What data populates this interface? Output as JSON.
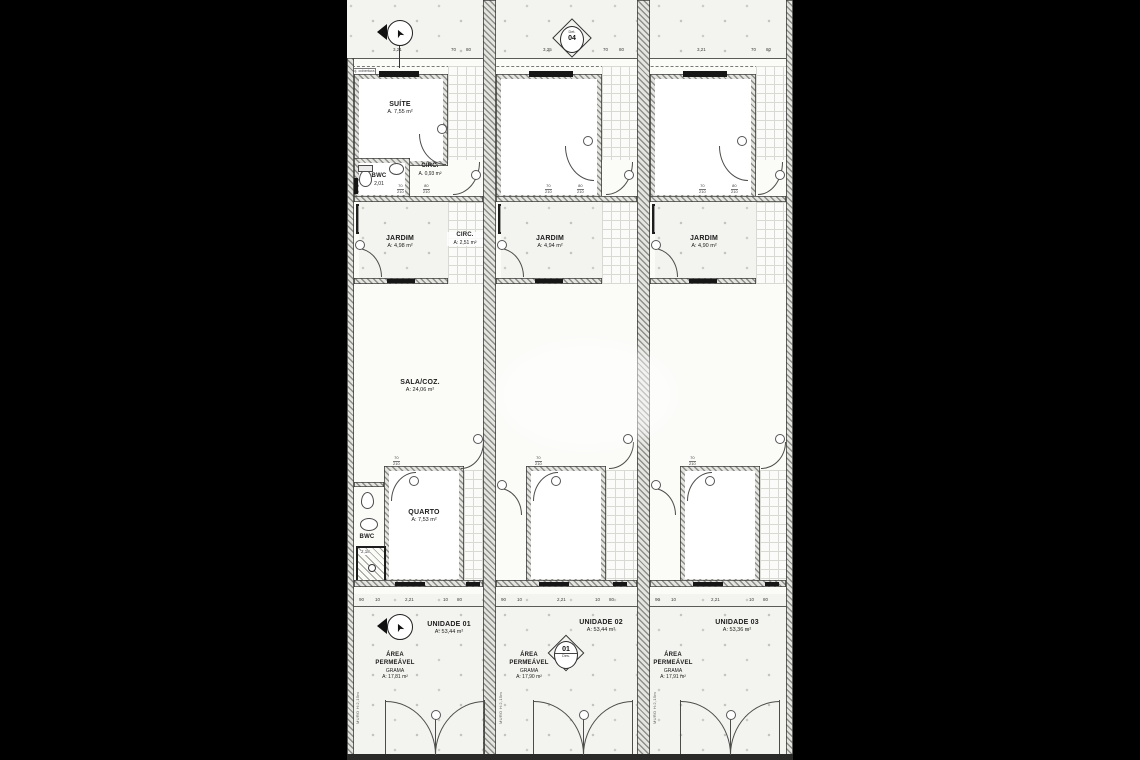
{
  "annotations": {
    "proj": "proj. cobertura",
    "muro": "MURO H:2,15m",
    "detail_top_code": "04",
    "detail_top_label": "Det.",
    "detail_bottom_code": "01",
    "detail_bottom_label": "Des.",
    "north_glyph": "➤"
  },
  "dims": {
    "top_u1": "3,21",
    "top_u2": "3,25",
    "top_u3": "3,21",
    "pair": [
      "70",
      "80"
    ],
    "door_w1": "70",
    "door_w2": "80",
    "door_h": "210",
    "tank": "2,20",
    "bottom": [
      "90",
      "10",
      "2,21",
      "10",
      "80"
    ]
  },
  "units": [
    {
      "title": "UNIDADE 01",
      "title_area": "A: 53,44 m²",
      "suite_name": "SUÍTE",
      "suite_area": "A. 7,55 m²",
      "bwc_top_name": "BWC",
      "bwc_top_area": "2,01",
      "circ_top_name": "CIRC.",
      "circ_top_area": "A. 0,93 m²",
      "ml": "ML",
      "jardim_name": "JARDIM",
      "jardim_area": "A: 4,98 m²",
      "circ_name": "CIRC.",
      "circ_area": "A: 2,51 m²",
      "sala_name": "SALA/COZ.",
      "sala_area": "A: 24,06 m²",
      "quarto_name": "QUARTO",
      "quarto_area": "A: 7,53 m²",
      "bwc2_name": "BWC",
      "bwc2_area": "2,18",
      "perm_l1": "ÁREA",
      "perm_l2": "PERMEÁVEL",
      "perm_l3": "GRAMA",
      "perm_area": "A: 17,81 m²"
    },
    {
      "title": "UNIDADE 02",
      "title_area": "A: 53,44 m²",
      "ml": "ML",
      "jardim_name": "JARDIM",
      "jardim_area": "A: 4,94 m²",
      "perm_l1": "ÁREA",
      "perm_l2": "PERMEÁVEL",
      "perm_l3": "GRAMA",
      "perm_area": "A: 17,90 m²"
    },
    {
      "title": "UNIDADE 03",
      "title_area": "A: 53,36 m²",
      "ml": "ML",
      "jardim_name": "JARDIM",
      "jardim_area": "A: 4,90 m²",
      "perm_l1": "ÁREA",
      "perm_l2": "PERMEÁVEL",
      "perm_l3": "GRAMA",
      "perm_area": "A: 17,91 m²"
    }
  ]
}
